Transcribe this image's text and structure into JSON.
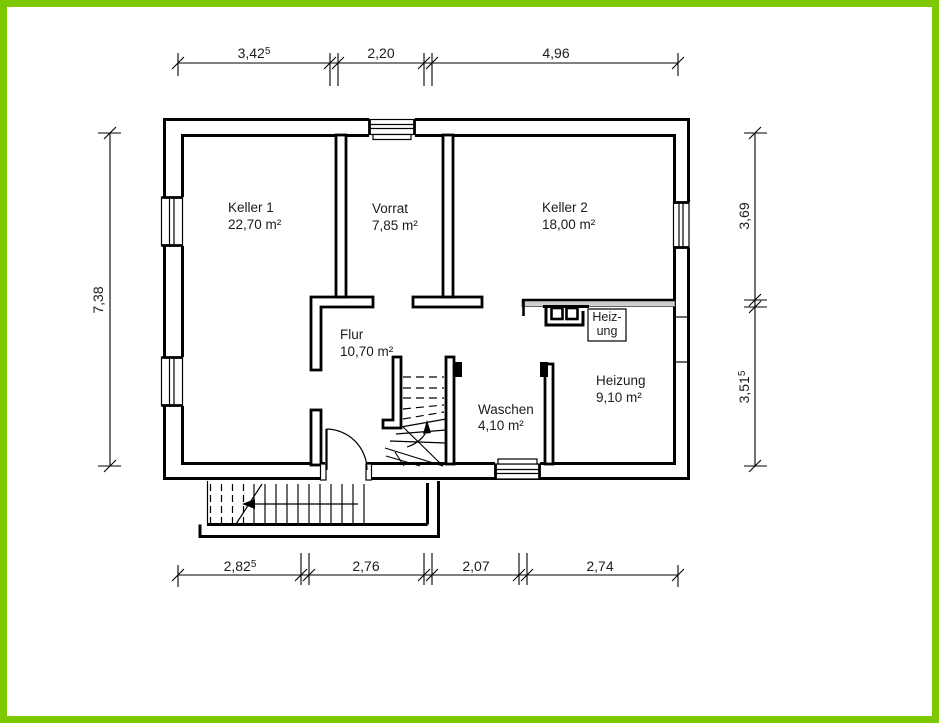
{
  "colors": {
    "frame_green": "#7dc801",
    "paper": "#ffffff",
    "ink": "#000000",
    "thin_wall_gray": "#cfcfcf"
  },
  "rooms": [
    {
      "id": "keller1",
      "name": "Keller 1",
      "area": "22,70 m²"
    },
    {
      "id": "vorrat",
      "name": "Vorrat",
      "area": "7,85 m²"
    },
    {
      "id": "keller2",
      "name": "Keller 2",
      "area": "18,00 m²"
    },
    {
      "id": "flur",
      "name": "Flur",
      "area": "10,70 m²"
    },
    {
      "id": "waschen",
      "name": "Waschen",
      "area": "4,10 m²"
    },
    {
      "id": "heizung",
      "name": "Heizung",
      "area": "9,10 m²"
    }
  ],
  "equipment": {
    "boiler_label_line1": "Heiz-",
    "boiler_label_line2": "ung"
  },
  "dimensions": {
    "top": [
      {
        "value": "3,42",
        "sup": "5"
      },
      {
        "value": "2,20",
        "sup": ""
      },
      {
        "value": "4,96",
        "sup": ""
      }
    ],
    "bottom": [
      {
        "value": "2,82",
        "sup": "5"
      },
      {
        "value": "2,76",
        "sup": ""
      },
      {
        "value": "2,07",
        "sup": ""
      },
      {
        "value": "2,74",
        "sup": ""
      }
    ],
    "left": [
      {
        "value": "7,38",
        "sup": ""
      }
    ],
    "right": [
      {
        "value": "3,69",
        "sup": ""
      },
      {
        "value": "3,51",
        "sup": "5"
      }
    ]
  }
}
